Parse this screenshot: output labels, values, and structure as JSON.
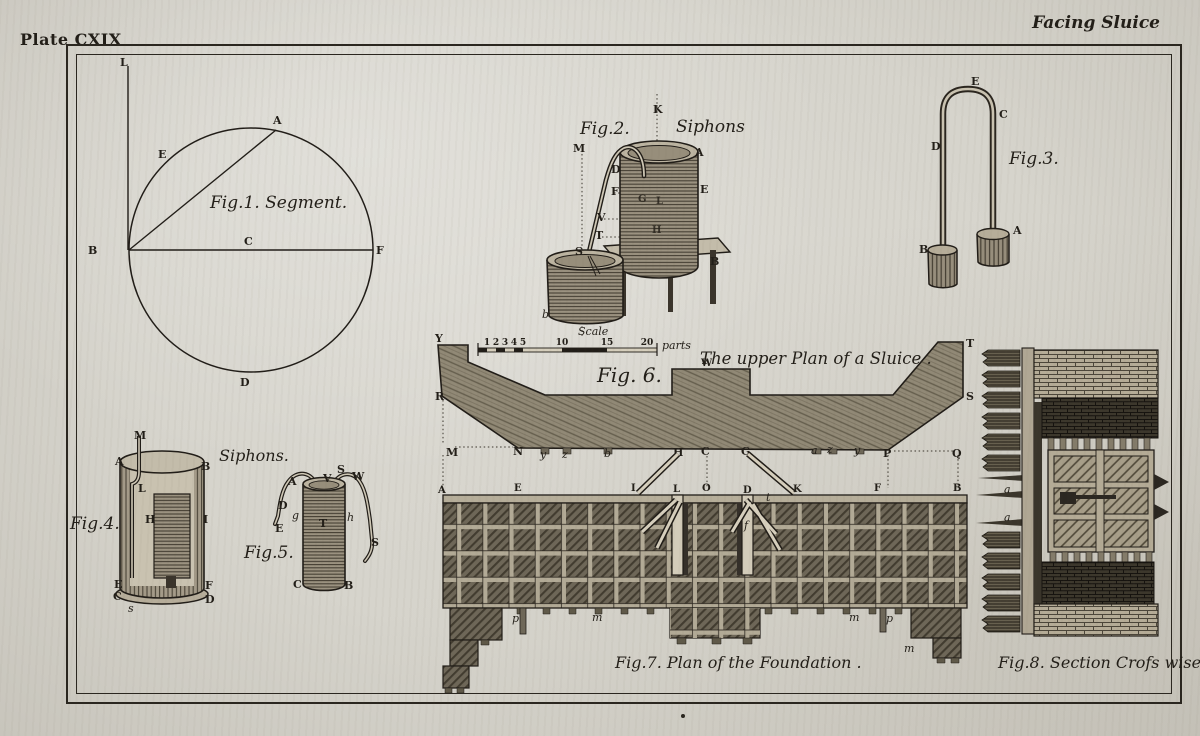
{
  "plate": {
    "title": "Plate CXIX",
    "heading": "Facing Sluice"
  },
  "fig1": {
    "caption": "Fig.1. Segment.",
    "labels": {
      "L": "L",
      "E": "E",
      "A": "A",
      "B": "B",
      "C": "C",
      "F": "F",
      "D": "D"
    }
  },
  "fig2": {
    "caption": "Fig.2.",
    "title": "Siphons",
    "labels": {
      "K": "K",
      "M": "M",
      "A": "A",
      "E": "E",
      "D": "D",
      "F": "F",
      "V": "V",
      "T": "T",
      "S": "S",
      "B": "B",
      "b": "b",
      "G": "G",
      "L": "L",
      "H": "H"
    }
  },
  "fig3": {
    "caption": "Fig.3.",
    "labels": {
      "E": "E",
      "C": "C",
      "D": "D",
      "A": "A",
      "B": "B"
    }
  },
  "fig4": {
    "caption": "Fig.4.",
    "group_title": "Siphons.",
    "labels": {
      "M": "M",
      "A": "A",
      "B": "B",
      "L": "L",
      "H": "H",
      "I": "I",
      "E": "E",
      "F": "F",
      "C": "C",
      "D": "D",
      "s": "s"
    }
  },
  "fig5": {
    "caption": "Fig.5.",
    "labels": {
      "A": "A",
      "V": "V",
      "S_top": "S",
      "W": "W",
      "D": "D",
      "g": "g",
      "E": "E",
      "T": "T",
      "h": "h",
      "S_right": "S",
      "C": "C",
      "B": "B"
    }
  },
  "fig6": {
    "caption": "Fig. 6.",
    "title": "The upper Plan of a Sluice .",
    "scale": {
      "label": "Scale",
      "ticks": [
        "1",
        "2",
        "3",
        "4",
        "5",
        "10",
        "15",
        "20"
      ],
      "unit": "parts"
    },
    "labels": {
      "Y": "Y",
      "R": "R",
      "M": "M",
      "N": "N",
      "y1": "y",
      "z1": "z",
      "b": "b",
      "W": "W",
      "H": "H",
      "C": "C",
      "G": "G",
      "a": "a",
      "z2": "z",
      "y2": "y",
      "P": "P",
      "Q": "Q",
      "S": "S",
      "T": "T"
    }
  },
  "fig7": {
    "caption": "Fig.7. Plan of the Foundation .",
    "labels": {
      "A": "A",
      "E": "E",
      "I": "I",
      "L": "L",
      "O": "O",
      "D": "D",
      "K": "K",
      "F": "F",
      "B": "B",
      "t": "t",
      "f": "f",
      "p1": "p",
      "m1": "m",
      "m2": "m",
      "p2": "p",
      "m3": "m"
    }
  },
  "fig8": {
    "caption": "Fig.8. Section Crofs wise",
    "labels": {
      "a1": "a",
      "a2": "a"
    }
  }
}
